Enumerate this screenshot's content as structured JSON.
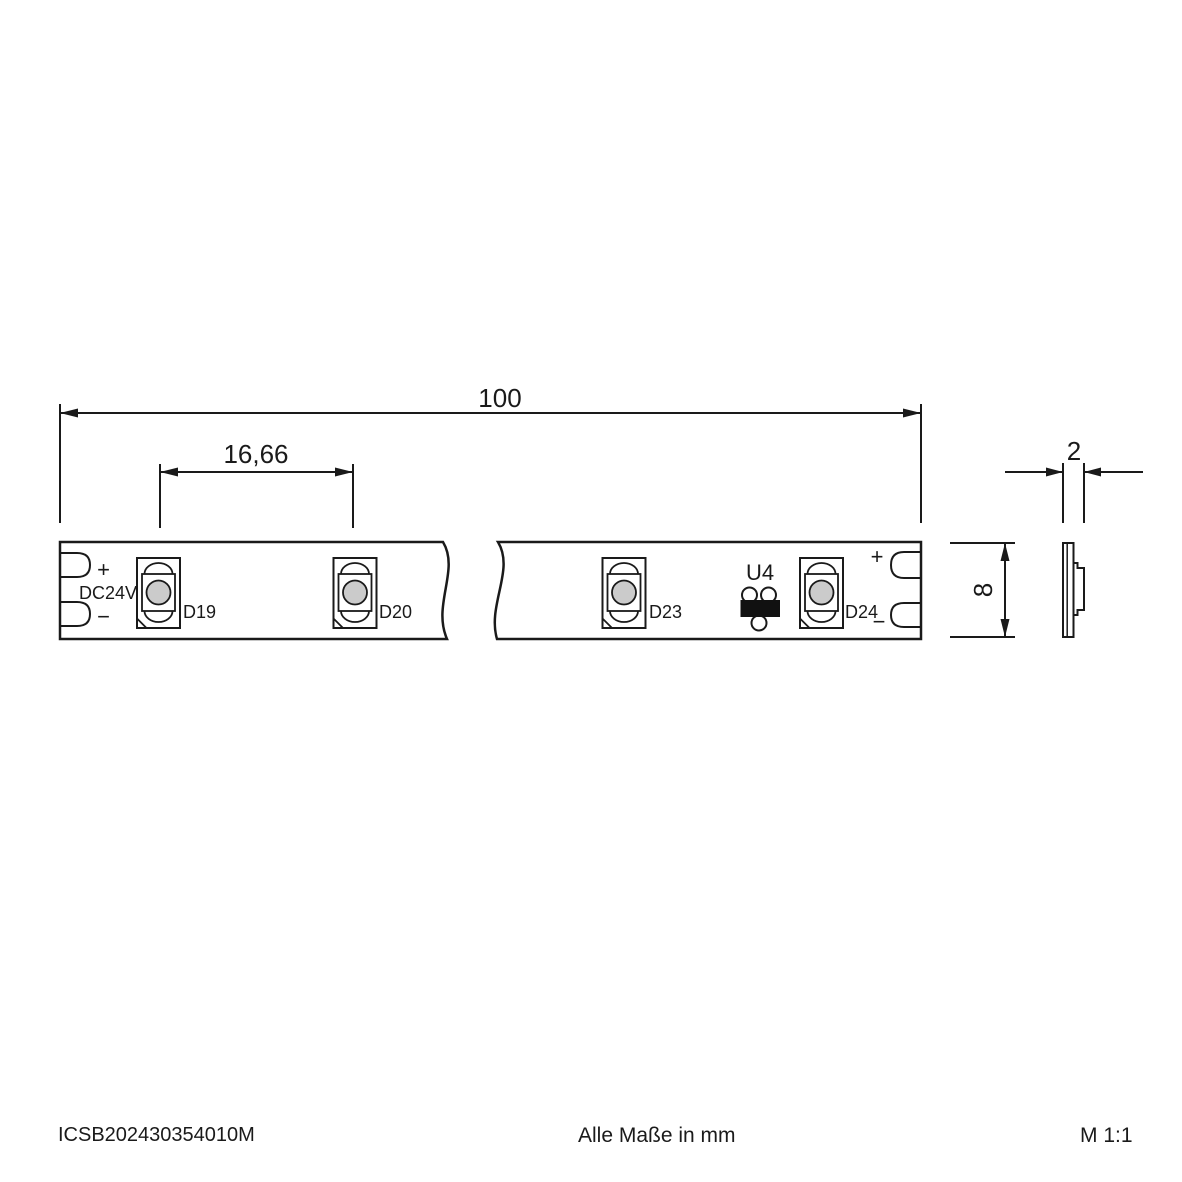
{
  "dimensions": {
    "total_length": "100",
    "led_pitch": "16,66",
    "thickness": "2",
    "strip_height": "8"
  },
  "strip": {
    "voltage": "DC24V",
    "plus": "+",
    "minus": "−",
    "leds": [
      "D19",
      "D20",
      "D23",
      "D24"
    ],
    "ic": "U4"
  },
  "footer": {
    "article": "ICSB202430354010M",
    "note": "Alle Maße in mm",
    "scale": "M 1:1"
  },
  "colors": {
    "line": "#1a1a1a",
    "die_fill": "#cbcbcb",
    "ic_fill": "#111111"
  }
}
